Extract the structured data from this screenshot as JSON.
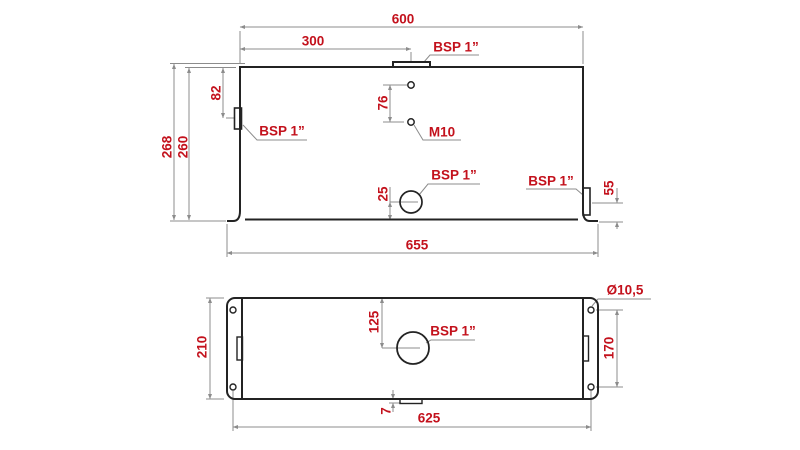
{
  "colors": {
    "dim_red": "#c3111c",
    "outline": "#232323",
    "dim_line": "#8c8c8c",
    "background": "#ffffff"
  },
  "front_view": {
    "dim_overall_width": "600",
    "dim_filler_position": "300",
    "label_filler_port": "BSP 1”",
    "dim_left_port_offset": "82",
    "label_left_port": "BSP 1”",
    "dim_total_height": "268",
    "dim_body_height": "260",
    "dim_m10_spacing": "76",
    "label_m10_holes": "M10",
    "dim_drain_height": "25",
    "label_drain_port": "BSP 1”",
    "label_right_port": "BSP 1”",
    "dim_right_port_height": "55",
    "dim_overall_length": "655"
  },
  "plan_view": {
    "dim_depth": "210",
    "dim_filler_offset": "125",
    "label_filler_port": "BSP 1”",
    "label_hole_diameter": "Ø10,5",
    "dim_hole_spacing_width": "170",
    "dim_drain_offset": "7",
    "dim_hole_spacing_length": "625"
  }
}
